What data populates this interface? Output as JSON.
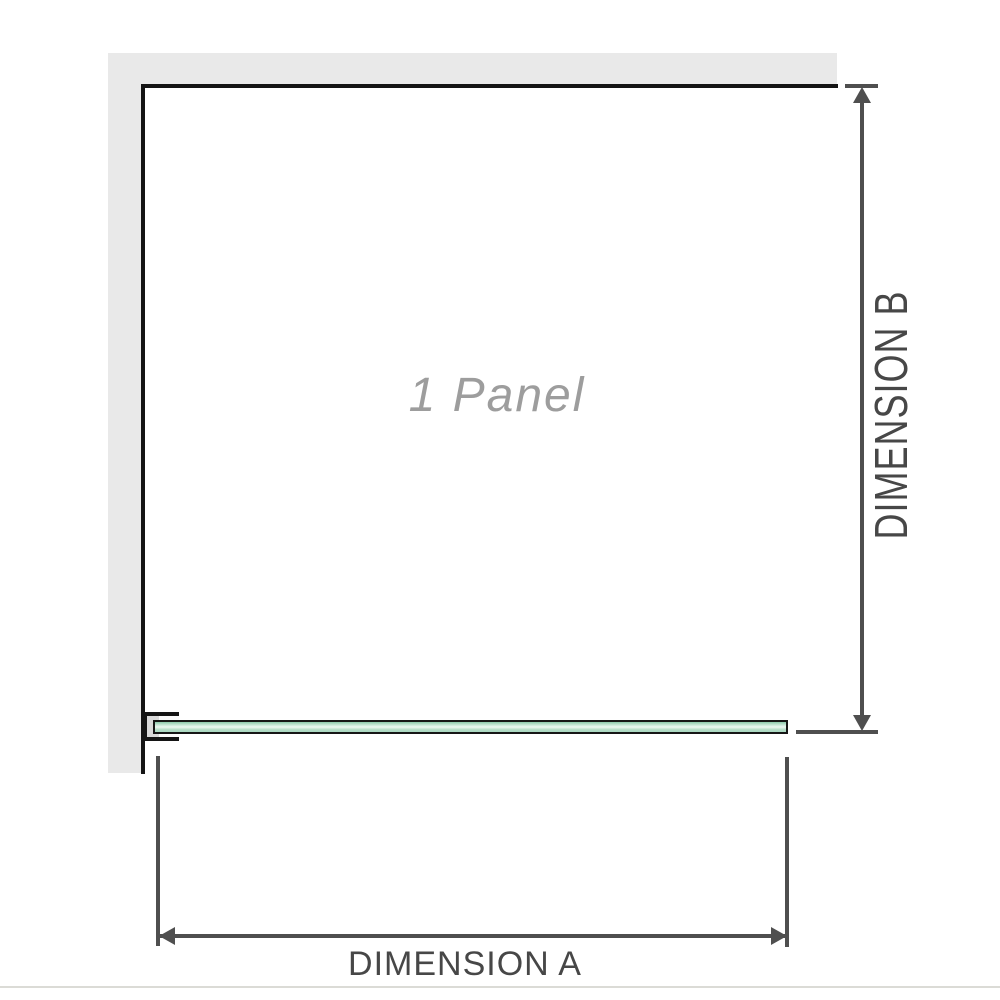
{
  "diagram": {
    "type": "shower-screen-top-view-dimension-diagram",
    "panel_label": "1 Panel",
    "dimension_a": {
      "label": "DIMENSION A",
      "orientation": "horizontal"
    },
    "dimension_b": {
      "label": "DIMENSION B",
      "orientation": "vertical"
    },
    "icons": {
      "arrow_up": "arrow-up-icon",
      "arrow_down": "arrow-down-icon",
      "arrow_left": "arrow-left-icon",
      "arrow_right": "arrow-right-icon"
    },
    "colors": {
      "background": "#ffffff",
      "wall_fill": "#e9e9e9",
      "wall_outline": "#141414",
      "dimension_line": "#4f4f4f",
      "dimension_text": "#474747",
      "panel_label_text": "#9d9d9d",
      "glass_border": "#161616",
      "glass_green_top": "#8cc9aa",
      "glass_green_highlight": "#eef8f2",
      "glass_green_bottom": "#a8d8c0",
      "bracket_inner": "#d9d9d9",
      "bottom_divider": "#dbdbd6"
    }
  }
}
